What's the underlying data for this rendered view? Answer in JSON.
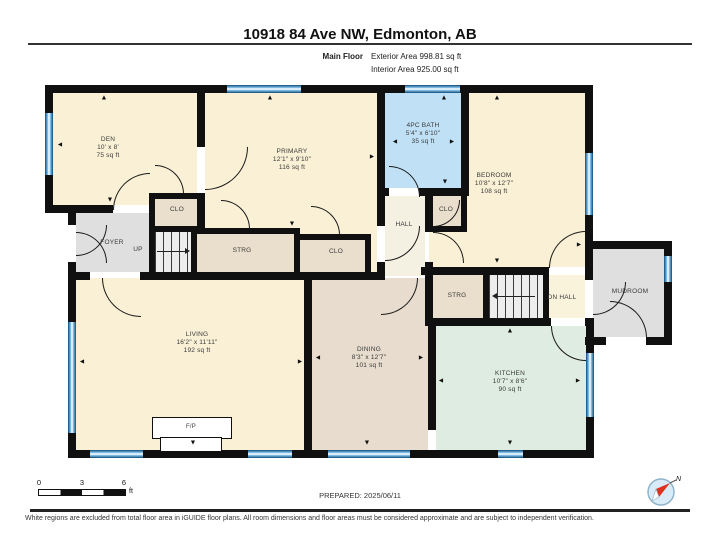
{
  "header": {
    "title": "10918 84 Ave NW, Edmonton, AB",
    "floor_label": "Main Floor",
    "exterior_area": "Exterior Area 998.81 sq ft",
    "interior_area": "Interior Area 925.00 sq ft"
  },
  "rooms": {
    "den": {
      "name": "DEN",
      "dims": "10' x 8'",
      "area": "75 sq ft"
    },
    "primary": {
      "name": "PRIMARY",
      "dims": "12'1\" x 9'10\"",
      "area": "116 sq ft"
    },
    "bath": {
      "name": "4PC BATH",
      "dims": "5'4\" x 6'10\"",
      "area": "35 sq ft"
    },
    "bedroom": {
      "name": "BEDROOM",
      "dims": "10'8\" x 12'7\"",
      "area": "108 sq ft"
    },
    "living": {
      "name": "LIVING",
      "dims": "16'2\" x 11'11\"",
      "area": "192 sq ft"
    },
    "dining": {
      "name": "DINING",
      "dims": "8'3\" x 12'7\"",
      "area": "101 sq ft"
    },
    "kitchen": {
      "name": "KITCHEN",
      "dims": "10'7\" x 8'6\"",
      "area": "90 sq ft"
    },
    "foyer": {
      "name": "FOYER"
    },
    "hall": {
      "name": "HALL"
    },
    "dn_hall": {
      "name": "DN  HALL"
    },
    "mudroom": {
      "name": "MUDROOM"
    },
    "clo_upper": {
      "name": "CLO"
    },
    "clo_mid": {
      "name": "CLO"
    },
    "clo_mid2": {
      "name": "CLO"
    },
    "strg_upper": {
      "name": "STRG"
    },
    "strg_lower": {
      "name": "STRG"
    },
    "stairs_up": {
      "name": "UP"
    },
    "fireplace": {
      "name": "F/P"
    }
  },
  "scale": {
    "n0": "0",
    "n1": "3",
    "n2": "6",
    "unit": "ft"
  },
  "footer": {
    "prepared": "PREPARED: 2025/06/11",
    "disclaimer": "White regions are excluded from total floor area in iGUIDE floor plans. All room dimensions and floor areas must be considered approximate and are subject to independent verification.",
    "compass_label": "N"
  },
  "icons": {
    "arrow_up": "▲",
    "arrow_down": "▼",
    "arrow_left": "◄",
    "arrow_right": "►"
  },
  "colors": {
    "wall": "#101010",
    "window_blue": "#7db9e2",
    "room_cream": "#f9f0d5",
    "room_tan": "#eadfcc",
    "room_dining": "#e7dccd",
    "room_kitchen": "#dfece2",
    "room_bath": "#c0e1f5",
    "room_gray": "#dfdfdf",
    "room_stairs": "#ededed",
    "room_hall": "#f4f0e2",
    "room_dnhall": "#faf3dc"
  }
}
